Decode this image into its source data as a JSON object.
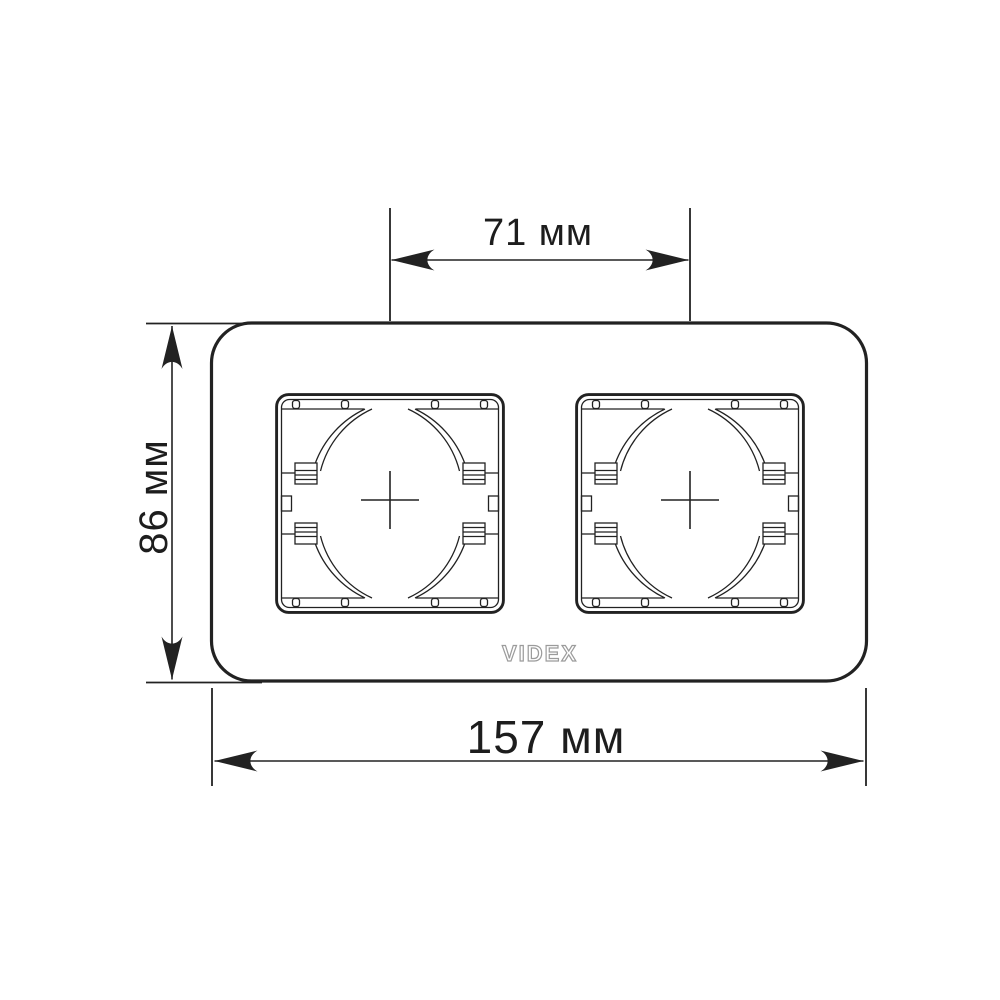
{
  "diagram": {
    "brand": "VIDEX",
    "dimensions": {
      "top": {
        "label": "71 мм",
        "value": 71,
        "unit": "мм",
        "measures": "distance between socket opening centers"
      },
      "height": {
        "label": "86 мм",
        "value": 86,
        "unit": "мм",
        "measures": "frame height"
      },
      "width": {
        "label": "157 мм",
        "value": 157,
        "unit": "мм",
        "measures": "frame width"
      }
    },
    "colors": {
      "line": "#222222",
      "text": "#1d1d1d",
      "logo": "#9b9b9b",
      "background": "#ffffff"
    }
  }
}
